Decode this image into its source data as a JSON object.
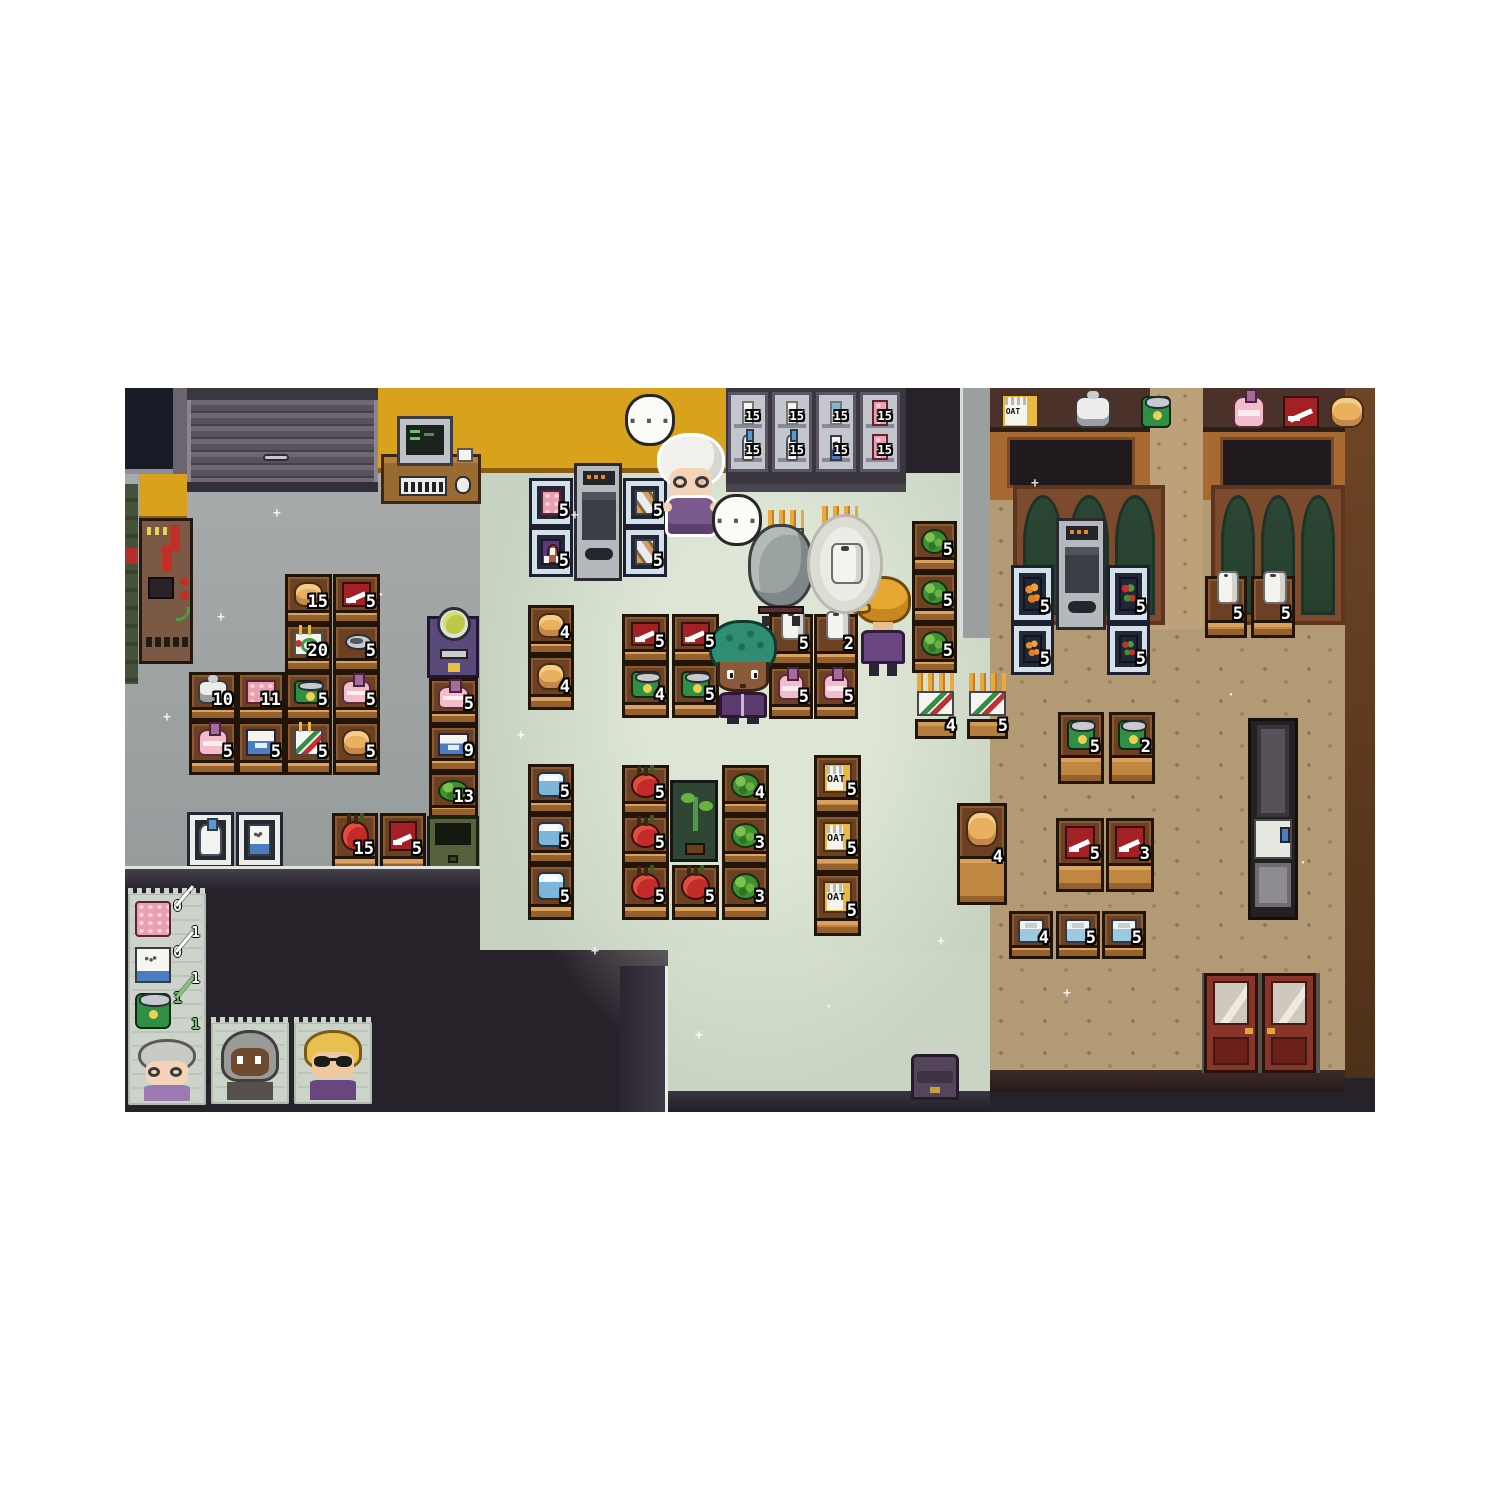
{
  "palette": {
    "void": "#27212a",
    "backroom_floor": "#a0a5a6",
    "store_floor": "#ccd7c6",
    "wood_floor": "#b29a74",
    "yellow_wall": "#d9a21c",
    "brown_wall": "#a86a33",
    "count_text": "#ffffff",
    "list_done_green": "#7ec87e"
  },
  "labels": {
    "oat": "OAT"
  },
  "bubbles": [
    {
      "text": "..."
    },
    {
      "text": "..."
    }
  ],
  "stock": {
    "backroom": [
      {
        "item": "bread",
        "count": "15"
      },
      {
        "item": "running-shoe",
        "count": "5"
      },
      {
        "item": "birthday-cake",
        "count": "20"
      },
      {
        "item": "canned-food",
        "count": "5"
      },
      {
        "item": "green-can",
        "count": "5"
      },
      {
        "item": "pink-bottle",
        "count": "5"
      },
      {
        "item": "pasta-box",
        "count": "5"
      },
      {
        "item": "bread",
        "count": "5"
      },
      {
        "item": "rice-cooker",
        "count": "10"
      },
      {
        "item": "meat",
        "count": "11"
      },
      {
        "item": "pink-bottle",
        "count": "5"
      },
      {
        "item": "blue-box",
        "count": "5"
      },
      {
        "item": "pink-bottle",
        "count": "5"
      },
      {
        "item": "blue-box",
        "count": "9"
      },
      {
        "item": "cabbage",
        "count": "13"
      },
      {
        "item": "apple",
        "count": "15"
      },
      {
        "item": "running-shoe",
        "count": "5"
      }
    ],
    "wall_displays": [
      {
        "item": "meat",
        "count": "5"
      },
      {
        "item": "tombstone",
        "count": "5"
      },
      {
        "item": "bread-rack",
        "count": "5"
      },
      {
        "item": "bread-rack",
        "count": "5"
      }
    ],
    "fridge": [
      {
        "item": "milk-carton",
        "count": "15"
      },
      {
        "item": "milk-jug",
        "count": "15"
      },
      {
        "item": "milk-carton",
        "count": "15"
      },
      {
        "item": "milk-jug",
        "count": "15"
      },
      {
        "item": "yogurt-tub",
        "count": "15"
      },
      {
        "item": "dairy-box",
        "count": "15"
      },
      {
        "item": "meat",
        "count": "15"
      },
      {
        "item": "meat",
        "count": "15"
      }
    ],
    "store": [
      {
        "item": "bread",
        "count": "4"
      },
      {
        "item": "bread",
        "count": "4"
      },
      {
        "item": "water-jug",
        "count": "5"
      },
      {
        "item": "water-jug",
        "count": "5"
      },
      {
        "item": "water-jug",
        "count": "5"
      },
      {
        "item": "running-shoe",
        "count": "5"
      },
      {
        "item": "running-shoe",
        "count": "5"
      },
      {
        "item": "green-can",
        "count": "4"
      },
      {
        "item": "green-can",
        "count": "5"
      },
      {
        "item": "apple",
        "count": "5"
      },
      {
        "item": "apple",
        "count": "5"
      },
      {
        "item": "apple",
        "count": "5"
      },
      {
        "item": "apple",
        "count": "5"
      },
      {
        "item": "cabbage",
        "count": "4"
      },
      {
        "item": "cabbage",
        "count": "3"
      },
      {
        "item": "cabbage",
        "count": "3"
      },
      {
        "item": "oat-box",
        "count": "5"
      },
      {
        "item": "oat-box",
        "count": "5"
      },
      {
        "item": "oat-box",
        "count": "5"
      },
      {
        "item": "toilet-paper",
        "count": "5"
      },
      {
        "item": "toilet-paper",
        "count": "2"
      },
      {
        "item": "pink-bottle",
        "count": "5"
      },
      {
        "item": "pink-bottle",
        "count": "5"
      },
      {
        "item": "cabbage",
        "count": "5"
      },
      {
        "item": "cabbage",
        "count": "5"
      },
      {
        "item": "cabbage",
        "count": "5"
      },
      {
        "item": "incense-sticks",
        "count": "4"
      },
      {
        "item": "incense-sticks",
        "count": "5"
      },
      {
        "item": "bread",
        "count": "4"
      }
    ],
    "right": [
      {
        "item": "carrots",
        "count": "5"
      },
      {
        "item": "peppers",
        "count": "5"
      },
      {
        "item": "carrots",
        "count": "5"
      },
      {
        "item": "peppers",
        "count": "5"
      },
      {
        "item": "toilet-paper",
        "count": "5"
      },
      {
        "item": "toilet-paper",
        "count": "5"
      },
      {
        "item": "green-can",
        "count": "5"
      },
      {
        "item": "green-can",
        "count": "2"
      },
      {
        "item": "running-shoe",
        "count": "5"
      },
      {
        "item": "running-shoe",
        "count": "3"
      },
      {
        "item": "cooler-box",
        "count": "4"
      },
      {
        "item": "cooler-box",
        "count": "5"
      },
      {
        "item": "cooler-box",
        "count": "5"
      }
    ]
  },
  "shopping_list": {
    "entries": [
      {
        "item": "meat",
        "have": "0",
        "need": "1",
        "done": false
      },
      {
        "item": "dairy-box",
        "have": "0",
        "need": "1",
        "done": false
      },
      {
        "item": "green-can",
        "have": "1",
        "need": "1",
        "done": true
      }
    ]
  },
  "customers": [
    {
      "name": "old-lady"
    },
    {
      "name": "hooded-shopper"
    },
    {
      "name": "blonde-shopper"
    }
  ]
}
